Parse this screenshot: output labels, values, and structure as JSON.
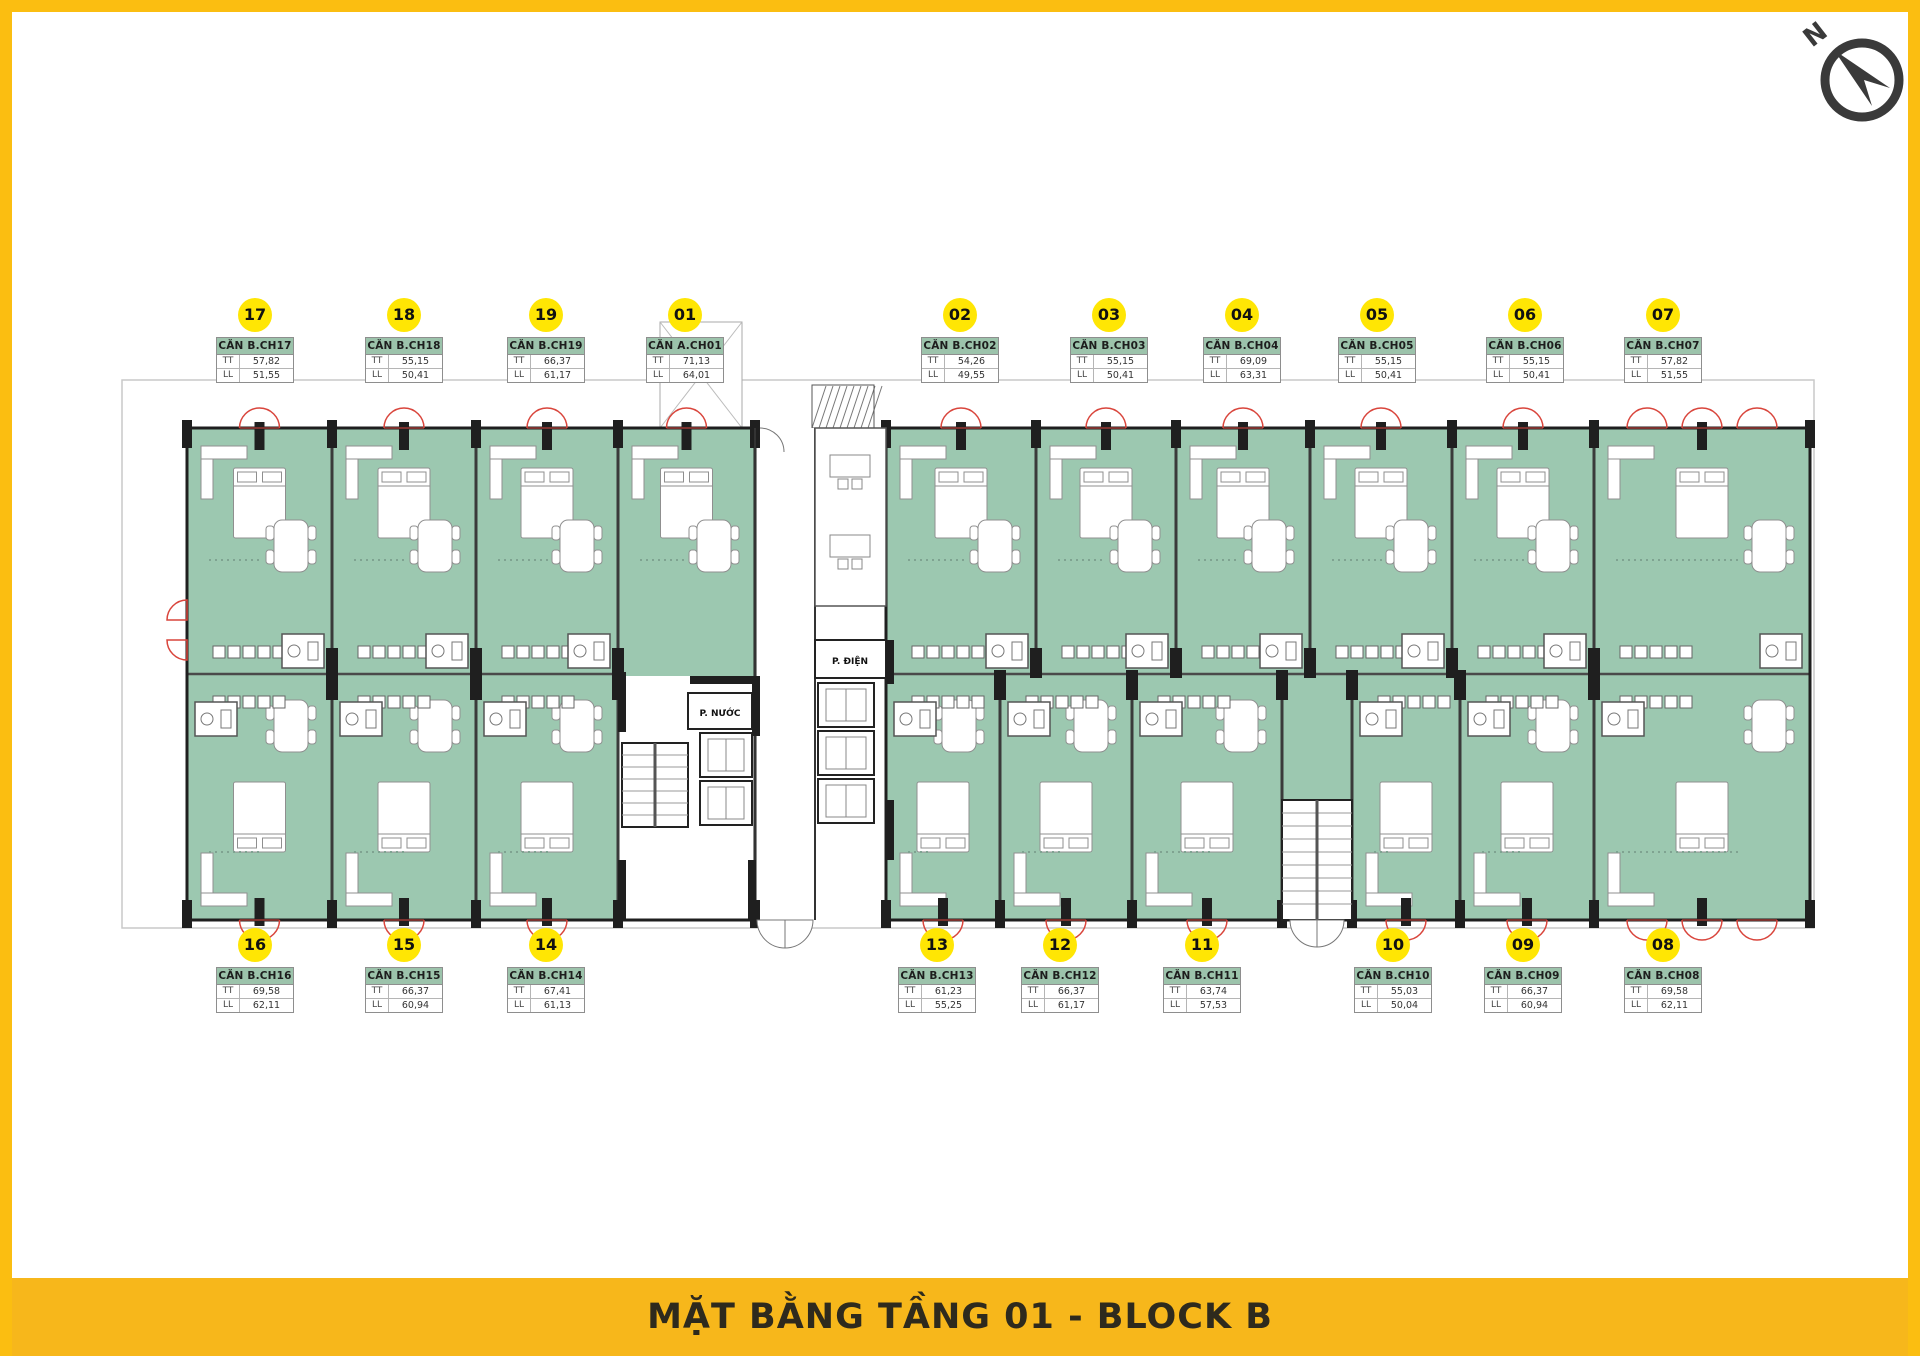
{
  "palette": {
    "frame_yellow": "#FBBE11",
    "banner_yellow": "#F7B71B",
    "circle_yellow": "#FFE604",
    "unit_green": "#9CC8B0",
    "header_green": "#9CC3AB",
    "wall_black": "#1F1F1F",
    "door_red": "#D9453C"
  },
  "banner": {
    "title": "MẶT BẰNG TẦNG 01 - BLOCK B"
  },
  "compass": {
    "north_label": "N"
  },
  "plan_labels": {
    "electrical_room": "P. ĐIỆN",
    "water_room": "P. NƯỚC",
    "area_field_tt": "TT",
    "area_field_ll": "LL"
  },
  "units_top": [
    {
      "no": "17",
      "name": "CĂN B.CH17",
      "tt": "57,82",
      "ll": "51,55"
    },
    {
      "no": "18",
      "name": "CĂN B.CH18",
      "tt": "55,15",
      "ll": "50,41"
    },
    {
      "no": "19",
      "name": "CĂN B.CH19",
      "tt": "66,37",
      "ll": "61,17"
    },
    {
      "no": "01",
      "name": "CĂN A.CH01",
      "tt": "71,13",
      "ll": "64,01"
    },
    {
      "no": "02",
      "name": "CĂN B.CH02",
      "tt": "54,26",
      "ll": "49,55"
    },
    {
      "no": "03",
      "name": "CĂN B.CH03",
      "tt": "55,15",
      "ll": "50,41"
    },
    {
      "no": "04",
      "name": "CĂN B.CH04",
      "tt": "69,09",
      "ll": "63,31"
    },
    {
      "no": "05",
      "name": "CĂN B.CH05",
      "tt": "55,15",
      "ll": "50,41"
    },
    {
      "no": "06",
      "name": "CĂN B.CH06",
      "tt": "55,15",
      "ll": "50,41"
    },
    {
      "no": "07",
      "name": "CĂN B.CH07",
      "tt": "57,82",
      "ll": "51,55"
    }
  ],
  "units_bottom": [
    {
      "no": "16",
      "name": "CĂN B.CH16",
      "tt": "69,58",
      "ll": "62,11"
    },
    {
      "no": "15",
      "name": "CĂN B.CH15",
      "tt": "66,37",
      "ll": "60,94"
    },
    {
      "no": "14",
      "name": "CĂN B.CH14",
      "tt": "67,41",
      "ll": "61,13"
    },
    {
      "no": "13",
      "name": "CĂN B.CH13",
      "tt": "61,23",
      "ll": "55,25"
    },
    {
      "no": "12",
      "name": "CĂN B.CH12",
      "tt": "66,37",
      "ll": "61,17"
    },
    {
      "no": "11",
      "name": "CĂN B.CH11",
      "tt": "63,74",
      "ll": "57,53"
    },
    {
      "no": "10",
      "name": "CĂN B.CH10",
      "tt": "55,03",
      "ll": "50,04"
    },
    {
      "no": "09",
      "name": "CĂN B.CH09",
      "tt": "66,37",
      "ll": "60,94"
    },
    {
      "no": "08",
      "name": "CĂN B.CH08",
      "tt": "69,58",
      "ll": "62,11"
    }
  ]
}
